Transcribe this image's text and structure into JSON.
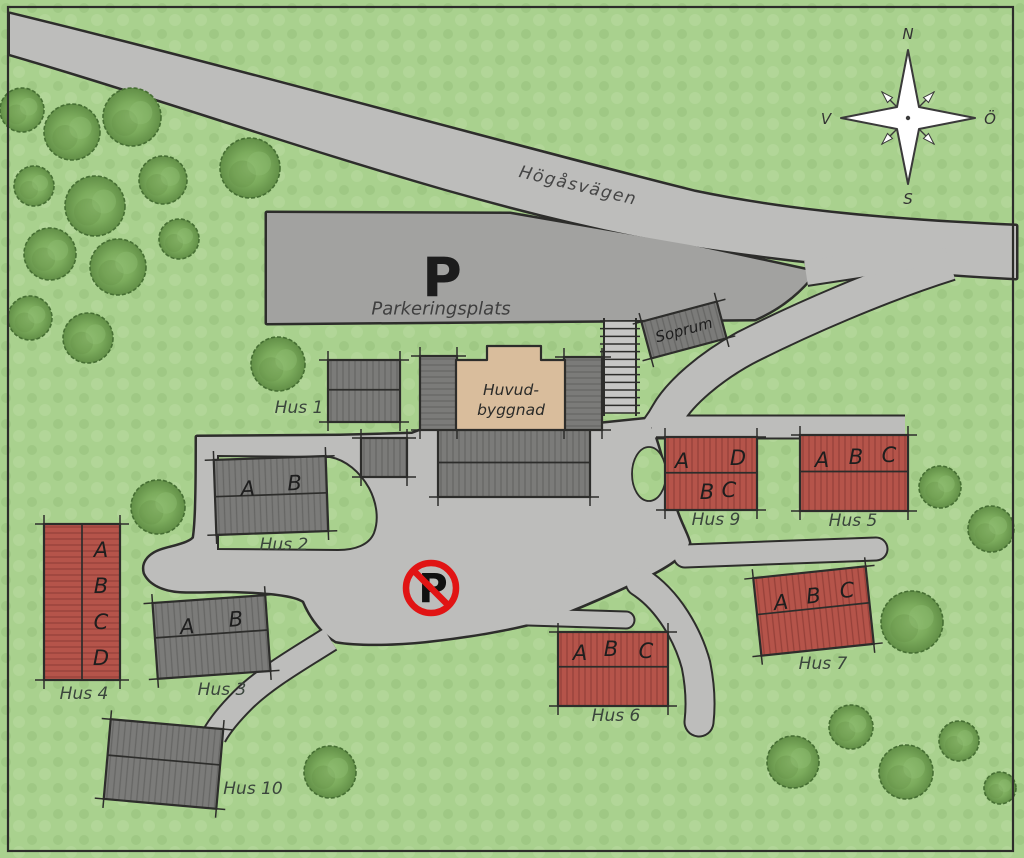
{
  "map": {
    "colors": {
      "grass": "#a9d18e",
      "grass_mottle1": "#9fc884",
      "grass_mottle2": "#b2d698",
      "road": "#bdbdbb",
      "parking": "#a2a2a0",
      "outline": "#2d2d2b",
      "building_gray": "#7b7b79",
      "building_gray_line": "#676765",
      "building_red": "#b5544a",
      "building_red_line": "#96413a",
      "building_tan": "#d9bd9c",
      "stairs_base": "#c6c6c4",
      "tree_mid": "#7bab5c",
      "tree_light": "#8fbd70",
      "tree_dark": "#628f47",
      "tree_stroke": "#466f33",
      "label_text": "#3a453c",
      "unit_text": "#1e1e1e",
      "road_text": "#454545",
      "sign_red": "#e11414",
      "sign_text": "#111111",
      "compass_stroke": "#3a3a3a"
    },
    "compass": {
      "north": "N",
      "south": "S",
      "west": "V",
      "east": "Ö",
      "cx": 908,
      "cy": 118
    },
    "road_label": {
      "text": "Högåsvägen",
      "x": 578,
      "y": 186,
      "rot": 13.5
    },
    "parking": {
      "symbol": "P",
      "symbol_x": 442,
      "symbol_y": 278,
      "label": "Parkeringsplats",
      "label_x": 441,
      "label_y": 309
    },
    "no_parking": {
      "symbol": "P",
      "x": 431,
      "y": 588,
      "r": 25
    },
    "main_building": {
      "lines": [
        "Huvud-",
        "byggnad"
      ],
      "line1_x": 511,
      "line1_y": 390,
      "line2_x": 511,
      "line2_y": 410,
      "outline_d": "M456 360 L487 360 L487 346 L541 346 L541 360 L565 360 L565 430 L456 430 Z"
    },
    "network": [
      {
        "id": "road-hogasvagen",
        "kind": "fill",
        "fill": "road",
        "d": "M 10 14 C 240 70 480 138 695 192 C 800 214 920 222 1016 226 L 1016 278 C 900 272 790 261 693 246 C 470 210 230 118 10 54 Z"
      },
      {
        "id": "parking-lot",
        "kind": "fill",
        "fill": "parking",
        "d": "M 267 213 L 510 214 L 690 245 L 815 272 C 800 292 780 308 755 319 L 267 323 Z"
      },
      {
        "id": "central-plaza",
        "kind": "fill",
        "fill": "road",
        "d": "M 197 437 L 340 436 L 412 434 L 428 428 L 600 424 L 648 419 C 658 442 666 478 674 504 C 680 524 687 534 689 543 C 686 553 670 565 645 577 C 618 590 578 608 550 618 C 515 629 462 637 425 641 C 396 644 358 645 336 641 C 323 633 311 618 304 601 C 294 594 266 592 238 591 C 220 590 200 592 180 591 C 164 590 150 584 145 573 C 142 562 150 553 166 549 C 178 546 190 543 194 538 C 197 520 197 470 197 437 Z"
      },
      {
        "id": "driveway",
        "kind": "stroke",
        "w": 33,
        "cap": "butt",
        "d": "M 950 263 C 880 285 800 320 745 348 C 710 367 680 393 668 414 C 663 423 659 428 657 431"
      },
      {
        "id": "parking-connector",
        "kind": "stroke",
        "w": 24,
        "cap": "butt",
        "d": "M 806 273 L 918 256"
      },
      {
        "id": "north-lane",
        "kind": "stroke",
        "w": 21,
        "cap": "butt",
        "d": "M 652 427 L 905 427"
      },
      {
        "id": "east-lane",
        "kind": "stroke",
        "w": 21,
        "cap": "round",
        "d": "M 685 556 L 876 549"
      },
      {
        "id": "stub-lane",
        "kind": "stroke",
        "w": 15,
        "cap": "round",
        "d": "M 528 617 L 626 620"
      },
      {
        "id": "south-lane",
        "kind": "stroke",
        "w": 27,
        "cap": "round",
        "d": "M 640 582 C 668 600 688 635 696 665 C 700 685 701 705 699 722"
      },
      {
        "id": "hus10-lane",
        "kind": "stroke",
        "w": 23,
        "cap": "butt",
        "d": "M 330 639 C 300 658 265 678 243 700 C 230 713 220 725 214 736"
      }
    ],
    "green_courtyard_d": "M 218 456 L 330 457 C 346 460 360 472 369 488 C 377 503 379 520 374 533 C 369 545 355 550 338 550 L 218 549 Z",
    "green_island": {
      "cx": 649,
      "cy": 474,
      "rx": 17,
      "ry": 27
    },
    "stairs": {
      "x": 604,
      "y": 321,
      "w": 32,
      "h": 92,
      "steps": 12
    },
    "buildings": [
      {
        "id": "main-lower",
        "x": 438,
        "y": 428,
        "w": 152,
        "h": 69,
        "rot": 0,
        "style": "gray-v",
        "ridge": [
          0.5
        ]
      },
      {
        "id": "main-left-wing",
        "x": 420,
        "y": 356,
        "w": 37,
        "h": 74,
        "rot": 0,
        "style": "gray-h",
        "ridge": []
      },
      {
        "id": "main-right-wing",
        "x": 564,
        "y": 357,
        "w": 38,
        "h": 73,
        "rot": 0,
        "style": "gray-h",
        "ridge": []
      },
      {
        "id": "annex-square",
        "x": 361,
        "y": 438,
        "w": 46,
        "h": 39,
        "rot": 0,
        "style": "gray-v",
        "ridge": []
      },
      {
        "id": "hus-1",
        "name": "Hus 1",
        "x": 328,
        "y": 360,
        "w": 72,
        "h": 62,
        "rot": 0,
        "style": "gray-v",
        "ridge": [
          0.48
        ],
        "units": [],
        "label": {
          "x": 299,
          "y": 408
        }
      },
      {
        "id": "hus-2",
        "name": "Hus 2",
        "x": 215,
        "y": 458,
        "w": 112,
        "h": 75,
        "rot": -2,
        "style": "gray-v",
        "ridge": [
          0.49
        ],
        "units": [
          {
            "t": "A",
            "x": 33,
            "y": 30
          },
          {
            "t": "B",
            "x": 80,
            "y": 26
          }
        ],
        "label": {
          "x": 284,
          "y": 545
        }
      },
      {
        "id": "hus-3",
        "name": "Hus 3",
        "x": 155,
        "y": 599,
        "w": 113,
        "h": 76,
        "rot": -4,
        "style": "gray-v",
        "ridge": [
          0.46
        ],
        "units": [
          {
            "t": "A",
            "x": 33,
            "y": 26
          },
          {
            "t": "B",
            "x": 82,
            "y": 22
          }
        ],
        "label": {
          "x": 222,
          "y": 690
        }
      },
      {
        "id": "hus-4",
        "name": "Hus 4",
        "x": 44,
        "y": 524,
        "w": 76,
        "h": 156,
        "rot": 0,
        "style": "red-h",
        "ridge": [],
        "vridge": [
          0.5
        ],
        "units": [
          {
            "t": "A",
            "x": 57,
            "y": 26
          },
          {
            "t": "B",
            "x": 57,
            "y": 62
          },
          {
            "t": "C",
            "x": 57,
            "y": 98
          },
          {
            "t": "D",
            "x": 57,
            "y": 134
          }
        ],
        "label": {
          "x": 84,
          "y": 694
        }
      },
      {
        "id": "hus-5",
        "name": "Hus 5",
        "x": 800,
        "y": 435,
        "w": 108,
        "h": 76,
        "rot": 0,
        "style": "red-v",
        "ridge": [
          0.48
        ],
        "units": [
          {
            "t": "A",
            "x": 22,
            "y": 25
          },
          {
            "t": "B",
            "x": 56,
            "y": 22
          },
          {
            "t": "C",
            "x": 89,
            "y": 20
          }
        ],
        "label": {
          "x": 853,
          "y": 521
        }
      },
      {
        "id": "hus-6",
        "name": "Hus 6",
        "x": 558,
        "y": 632,
        "w": 110,
        "h": 74,
        "rot": 0,
        "style": "red-v",
        "ridge": [
          0.47
        ],
        "units": [
          {
            "t": "A",
            "x": 22,
            "y": 21
          },
          {
            "t": "B",
            "x": 53,
            "y": 17
          },
          {
            "t": "C",
            "x": 88,
            "y": 19
          }
        ],
        "label": {
          "x": 616,
          "y": 716
        }
      },
      {
        "id": "hus-7",
        "name": "Hus 7",
        "x": 757,
        "y": 572,
        "w": 113,
        "h": 78,
        "rot": -6,
        "style": "red-v",
        "ridge": [
          0.47
        ],
        "units": [
          {
            "t": "A",
            "x": 25,
            "y": 27
          },
          {
            "t": "B",
            "x": 58,
            "y": 24
          },
          {
            "t": "C",
            "x": 92,
            "y": 22
          }
        ],
        "label": {
          "x": 823,
          "y": 664
        }
      },
      {
        "id": "hus-9",
        "name": "Hus 9",
        "x": 665,
        "y": 437,
        "w": 92,
        "h": 73,
        "rot": 0,
        "style": "red-v",
        "ridge": [
          0.49
        ],
        "units": [
          {
            "t": "A",
            "x": 17,
            "y": 24
          },
          {
            "t": "D",
            "x": 73,
            "y": 21
          },
          {
            "t": "B",
            "x": 42,
            "y": 55
          },
          {
            "t": "C",
            "x": 64,
            "y": 53
          }
        ],
        "label": {
          "x": 716,
          "y": 520
        }
      },
      {
        "id": "hus-10",
        "name": "Hus 10",
        "x": 107,
        "y": 724,
        "w": 113,
        "h": 80,
        "rot": 5,
        "style": "gray-v",
        "ridge": [
          0.45
        ],
        "units": [],
        "label": {
          "x": 253,
          "y": 789
        }
      },
      {
        "id": "soprum",
        "name": "Soprum",
        "x": 645,
        "y": 311,
        "w": 78,
        "h": 38,
        "rot": -15,
        "style": "gray-v",
        "ridge": [],
        "inner_label": true
      }
    ],
    "trees": [
      [
        22,
        110,
        22
      ],
      [
        72,
        132,
        28
      ],
      [
        132,
        117,
        29
      ],
      [
        250,
        168,
        30
      ],
      [
        34,
        186,
        20
      ],
      [
        95,
        206,
        30
      ],
      [
        163,
        180,
        24
      ],
      [
        50,
        254,
        26
      ],
      [
        118,
        267,
        28
      ],
      [
        179,
        239,
        20
      ],
      [
        30,
        318,
        22
      ],
      [
        88,
        338,
        25
      ],
      [
        278,
        364,
        27
      ],
      [
        158,
        507,
        27
      ],
      [
        330,
        772,
        26
      ],
      [
        793,
        762,
        26
      ],
      [
        851,
        727,
        22
      ],
      [
        906,
        772,
        27
      ],
      [
        959,
        741,
        20
      ],
      [
        1000,
        788,
        16
      ],
      [
        940,
        487,
        21
      ],
      [
        991,
        529,
        23
      ],
      [
        912,
        622,
        31
      ]
    ],
    "border": {
      "x": 8,
      "y": 7,
      "w": 1005,
      "h": 844
    }
  }
}
